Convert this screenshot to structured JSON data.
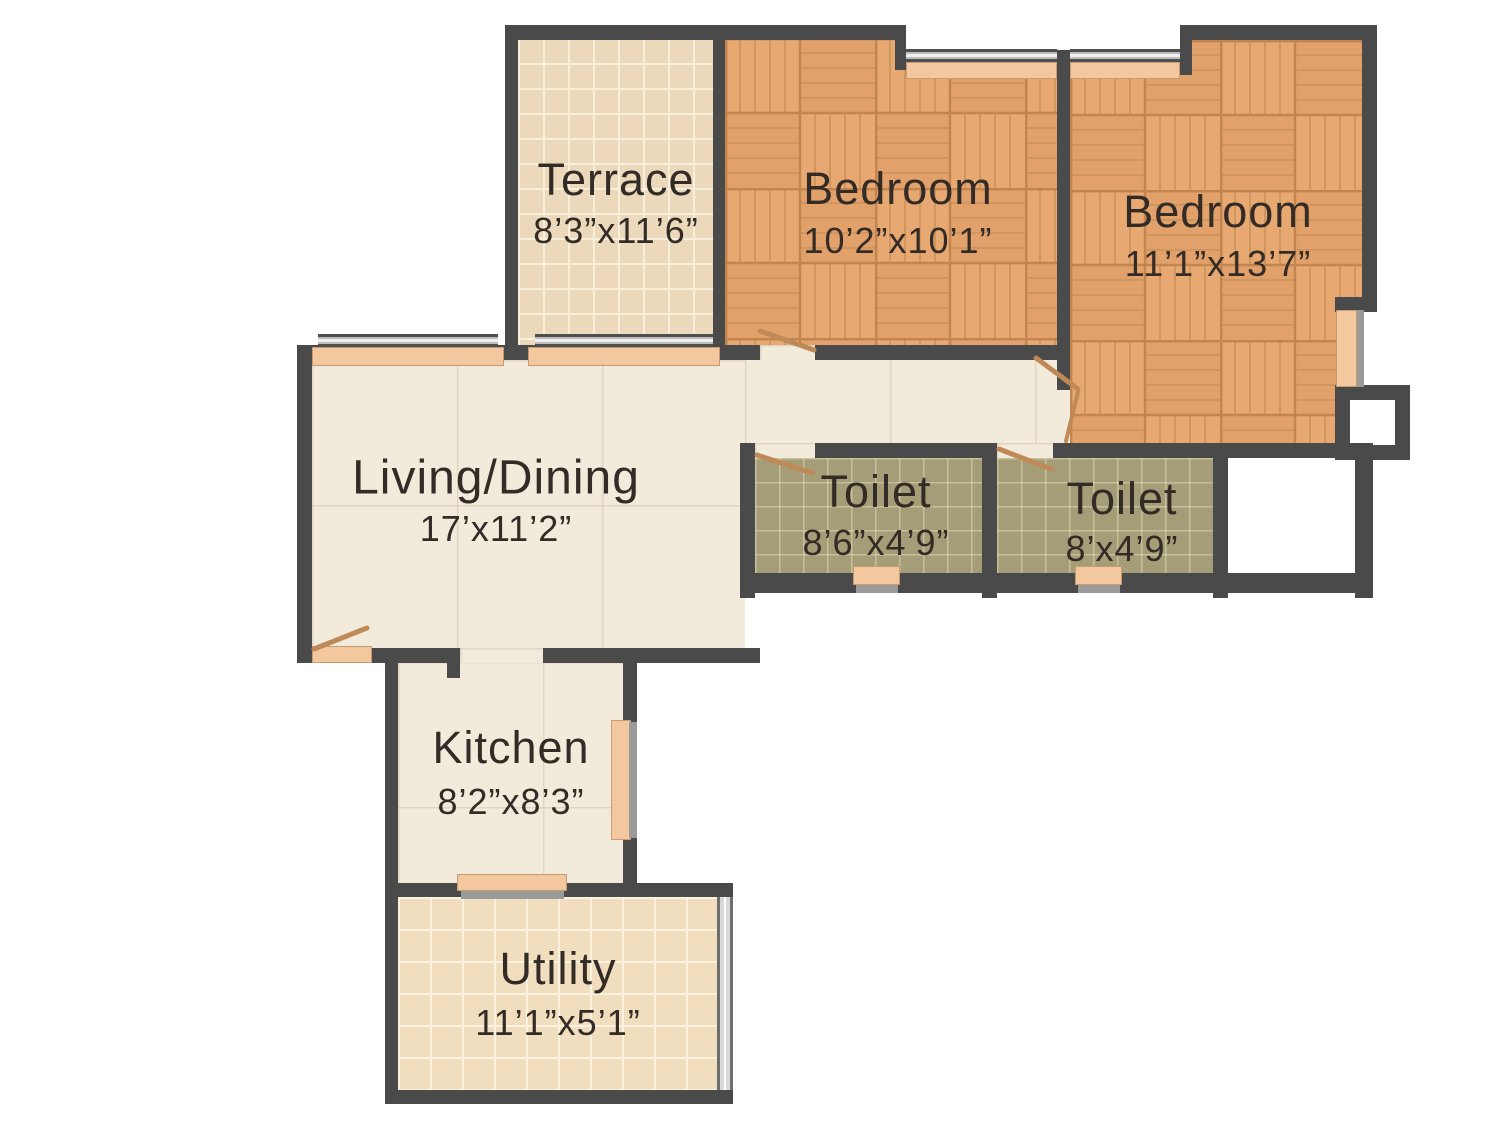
{
  "rooms": {
    "terrace": {
      "name": "Terrace",
      "dims": "8’3”x11’6”"
    },
    "bedroom_1": {
      "name": "Bedroom",
      "dims": "10’2”x10’1”"
    },
    "bedroom_2": {
      "name": "Bedroom",
      "dims": "11’1”x13’7”"
    },
    "living_dining": {
      "name": "Living/Dining",
      "dims": "17’x11’2”"
    },
    "toilet_1": {
      "name": "Toilet",
      "dims": "8’6”x4’9”"
    },
    "toilet_2": {
      "name": "Toilet",
      "dims": "8’x4’9”"
    },
    "kitchen": {
      "name": "Kitchen",
      "dims": "8’2”x8’3”"
    },
    "utility": {
      "name": "Utility",
      "dims": "11’1”x5’1”"
    }
  },
  "colors": {
    "wall": "#4a4a4a",
    "parquet_base": "#e6a873",
    "tile_beige": "#ecd8ba",
    "tile_cream": "#f2ebdc",
    "tile_olive": "#a49d77",
    "window_sill": "#f3c89e",
    "door_leaf": "#bf8a58",
    "label_text": "#332b26"
  }
}
